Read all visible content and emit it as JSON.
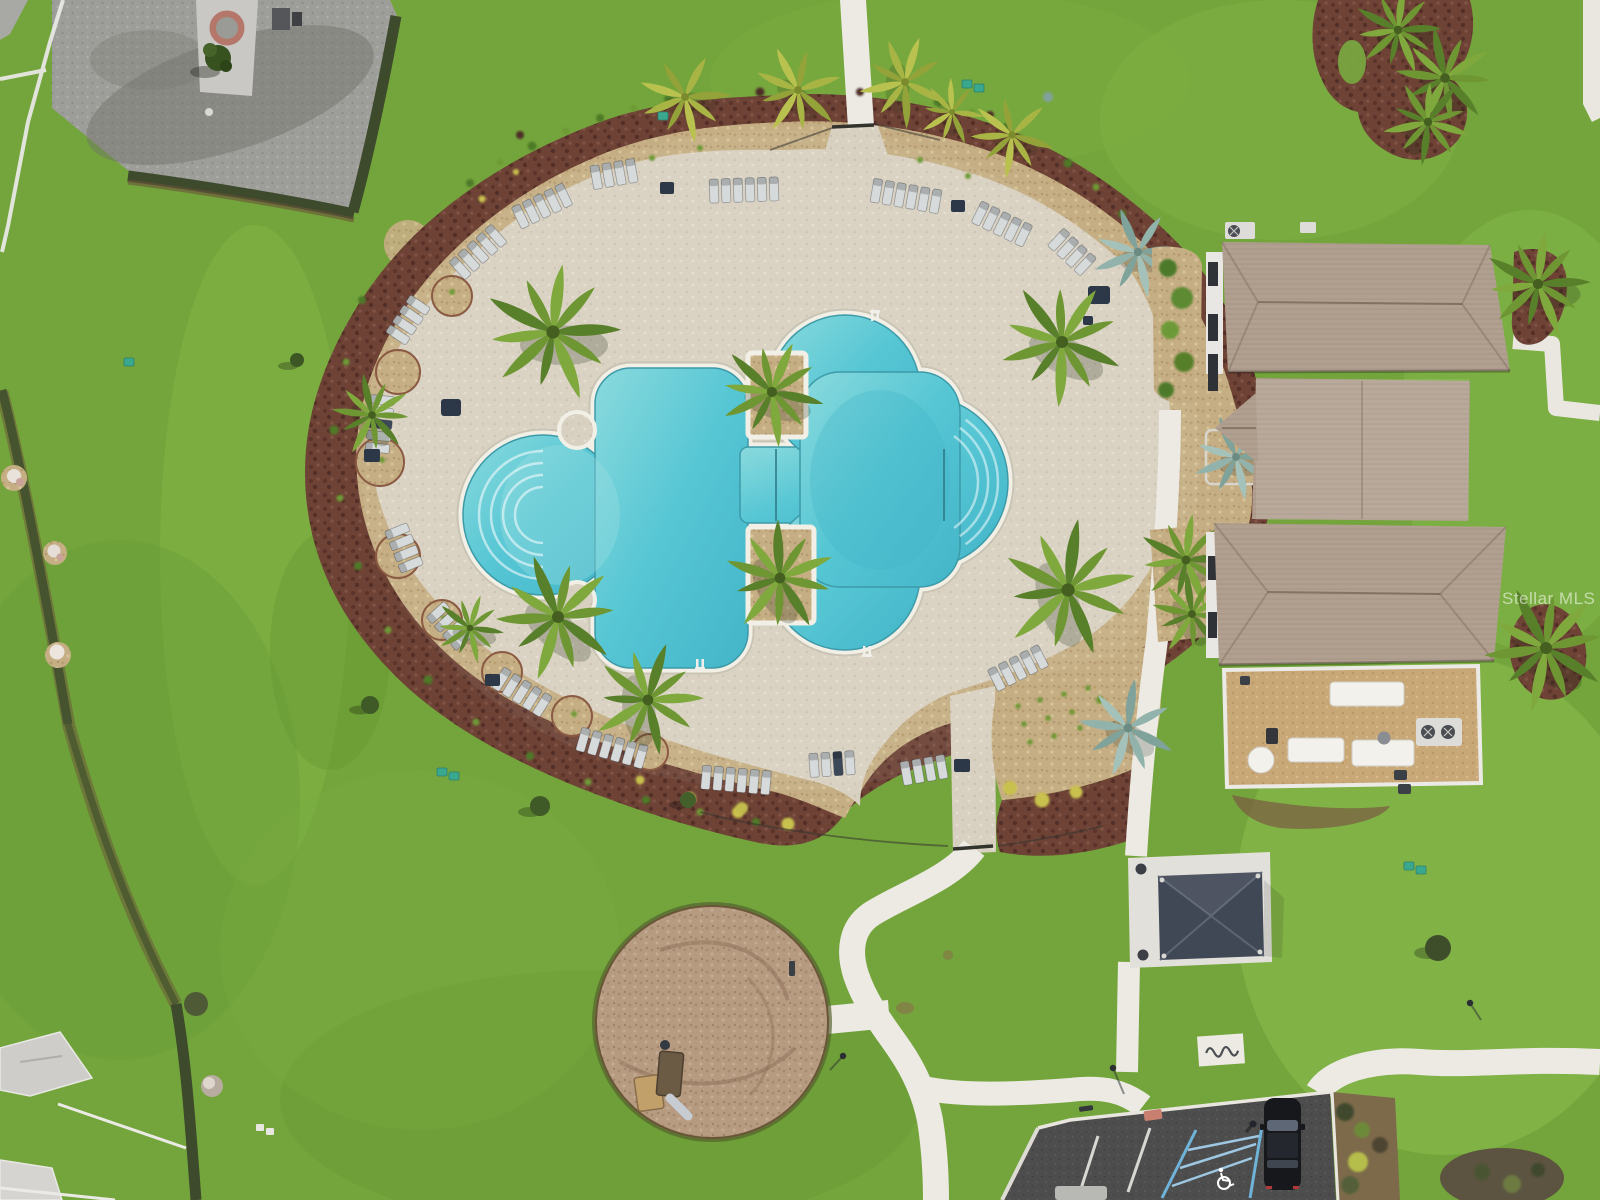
{
  "watermark": {
    "text": "Stellar MLS"
  },
  "scene": {
    "description": "Aerial drone photo of a community amenity center: free-form swimming pool on a paver sun deck ringed by landscape beds, lounge chairs and palms, with clubhouse, cabana pavilion, playground circle, sidewalks and a parking lot with a handicap space and one parked car",
    "features": [
      "swimming-pool",
      "sun-deck",
      "lounge-chairs",
      "palm-trees",
      "landscape-ring",
      "clubhouse",
      "patio-furniture",
      "cabana-pavilion",
      "playground",
      "bike-rack",
      "sidewalks",
      "parking-lot",
      "handicap-space",
      "parked-car",
      "lawns",
      "hedges",
      "houses",
      "gravel-pad"
    ]
  },
  "colors": {
    "water": "#56c6d4",
    "water_shallow": "#8adadd",
    "water_deep": "#43b5c8",
    "coping": "#f2f0e6",
    "deck_paver": "#d8d1c1",
    "grass": "#74a53c",
    "grass_light": "#8cc04f",
    "grass_dark": "#5f9230",
    "mulch_maroon": "#6e4336",
    "mulch_tan": "#c6ae84",
    "roof_shingle": "#b1a090",
    "pavilion_roof": "#414855",
    "concrete": "#eceae3",
    "asphalt": "#4d4d4d",
    "hedge": "#3d4a2c",
    "playground_mulch": "#b69b81",
    "parking_blue": "#6fb3d9",
    "car": "#16181c",
    "gravel": "#9d9d99",
    "teal_utility": "#3aa88f",
    "palm_green": "#6e9733",
    "agave_blue": "#8fb0a8",
    "furniture_navy": "#2c3748",
    "watermark_white": "#ffffff"
  }
}
